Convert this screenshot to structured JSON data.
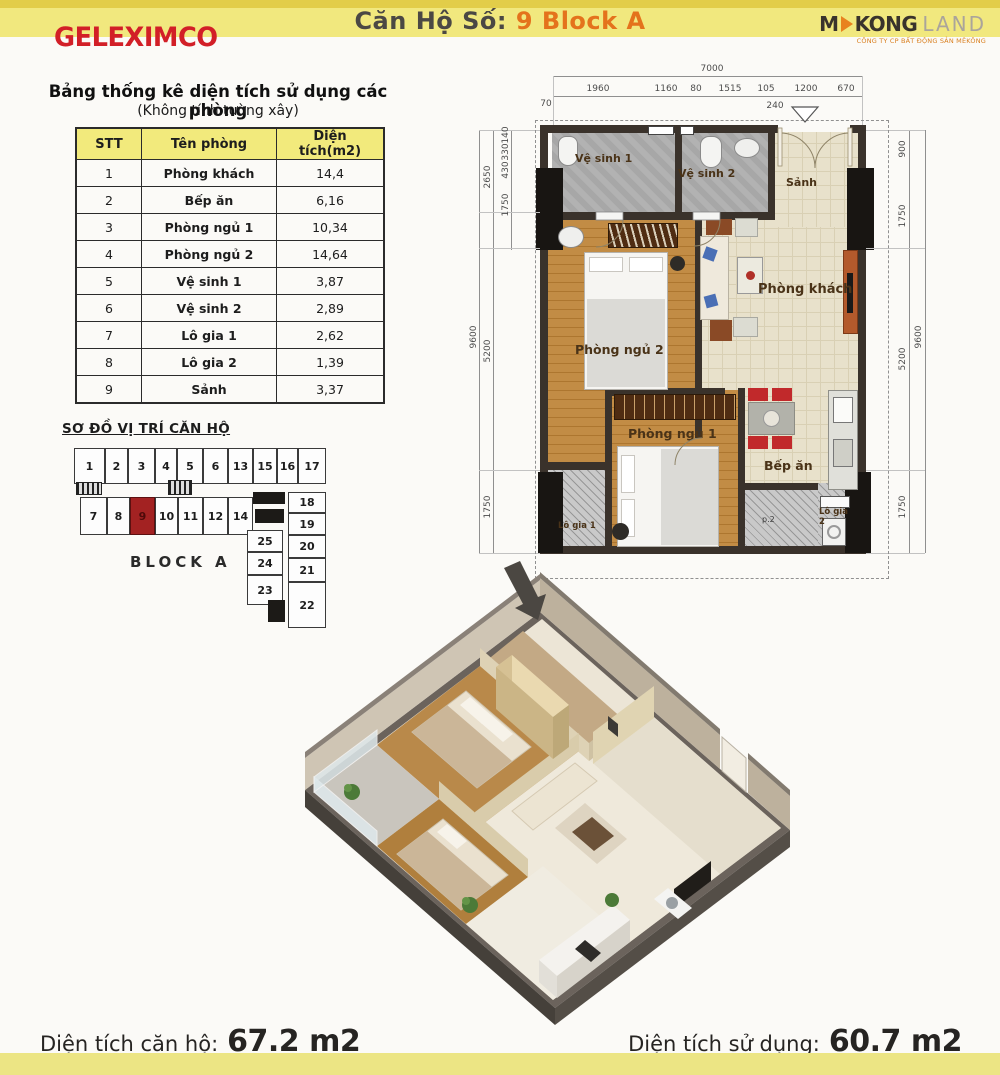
{
  "header": {
    "brand_left": "GELEXIMCO",
    "title_prefix": "Căn Hộ Số:",
    "title_value": "9 Block A",
    "brand_right_m": "M",
    "brand_right_kong": "KONG",
    "brand_right_land": "LAND",
    "brand_right_tagline": "CÔNG TY CP BẤT ĐỘNG SẢN MÊKÔNG"
  },
  "area_table": {
    "title": "Bảng thống kê diện tích sử dụng các phòng",
    "subtitle": "(Không tính tường xây)",
    "col_stt": "STT",
    "col_name": "Tên phòng",
    "col_area": "Diện tích(m2)",
    "rows": [
      {
        "stt": "1",
        "name": "Phòng khách",
        "area": "14,4"
      },
      {
        "stt": "2",
        "name": "Bếp ăn",
        "area": "6,16"
      },
      {
        "stt": "3",
        "name": "Phòng ngủ 1",
        "area": "10,34"
      },
      {
        "stt": "4",
        "name": "Phòng ngủ 2",
        "area": "14,64"
      },
      {
        "stt": "5",
        "name": "Vệ sinh 1",
        "area": "3,87"
      },
      {
        "stt": "6",
        "name": "Vệ sinh 2",
        "area": "2,89"
      },
      {
        "stt": "7",
        "name": "Lô gia 1",
        "area": "2,62"
      },
      {
        "stt": "8",
        "name": "Lô gia 2",
        "area": "1,39"
      },
      {
        "stt": "9",
        "name": "Sảnh",
        "area": "3,37"
      }
    ]
  },
  "location_map": {
    "title": "SƠ ĐỒ VỊ TRÍ CĂN HỘ",
    "block_label": "BLOCK A",
    "highlighted_unit": "9",
    "units": [
      "1",
      "2",
      "3",
      "4",
      "5",
      "6",
      "13",
      "15",
      "16",
      "17",
      "7",
      "8",
      "9",
      "10",
      "11",
      "12",
      "14",
      "18",
      "19",
      "20",
      "21",
      "22",
      "25",
      "24",
      "23"
    ]
  },
  "floorplan": {
    "rooms": {
      "ve_sinh_1": "Vệ sinh 1",
      "ve_sinh_2": "Vệ sinh 2",
      "sanh": "Sảnh",
      "phong_ngu_2": "Phòng ngủ 2",
      "phong_khach": "Phòng khách",
      "phong_ngu_1": "Phòng ngủ 1",
      "bep_an": "Bếp ăn",
      "lo_gia_1": "Lô gia 1",
      "lo_gia_2": "Lô gia 2",
      "utility": "p.2"
    },
    "dims": {
      "total_width": "7000",
      "top": [
        "1960",
        "1160",
        "80",
        "1515",
        "105",
        "1200",
        "670"
      ],
      "offset_left": "70",
      "offset_door": "240",
      "left_inner": [
        "140",
        "330",
        "430",
        "1750"
      ],
      "left_outer": [
        "2650",
        "5200",
        "1750"
      ],
      "total_depth_left": "9600",
      "right": [
        "900",
        "1750",
        "5200",
        "1750"
      ],
      "total_depth_right": "9600"
    }
  },
  "footer": {
    "left_label": "Diện tích căn hộ:",
    "left_value": "67.2 m2",
    "right_label": "Diện tích sử dụng:",
    "right_value": "60.7 m2"
  },
  "colors": {
    "band_yellow": "#f1e87e",
    "band_dark_yellow": "#e2cd49",
    "brand_red": "#d21f27",
    "accent_orange": "#e4731c",
    "highlight_unit_red": "#a32222"
  }
}
